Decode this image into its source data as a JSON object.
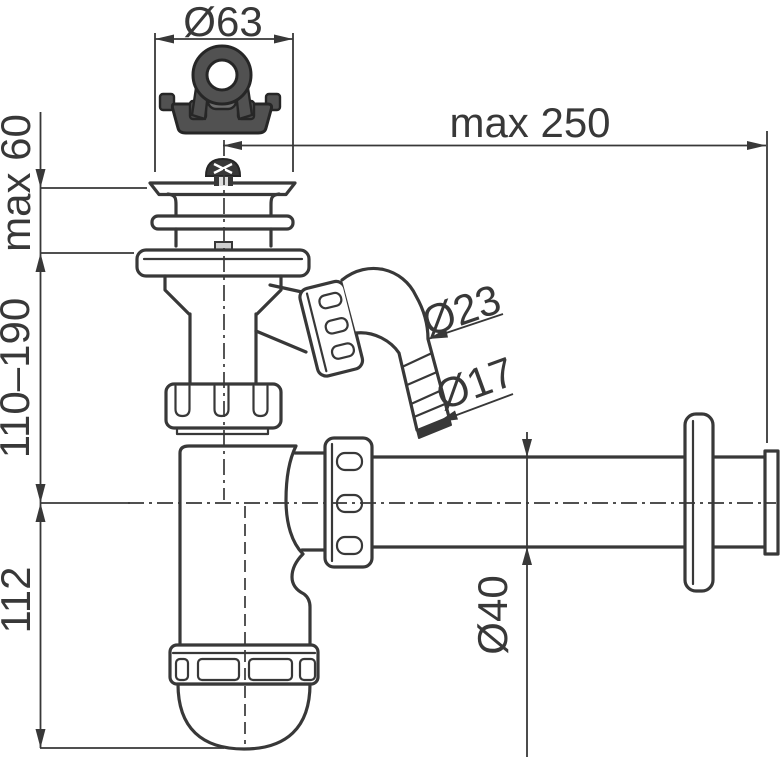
{
  "labels": {
    "plug_diameter": "Ø63",
    "max_reach": "max 250",
    "max_mount_height": "max 60",
    "height_range": "110–190",
    "cup_depth": "112",
    "elbow_diameter": "Ø23",
    "hose_tail_diameter": "Ø17",
    "pipe_diameter": "Ø40"
  },
  "colors": {
    "background": "#ffffff",
    "line": "#383838",
    "plug_fill": "#515151",
    "plug_outline": "#262626",
    "plug_boss_fill": "#6e6e6e",
    "screw_fill": "#383838",
    "metal_tab_fill": "#cfcfcf"
  }
}
